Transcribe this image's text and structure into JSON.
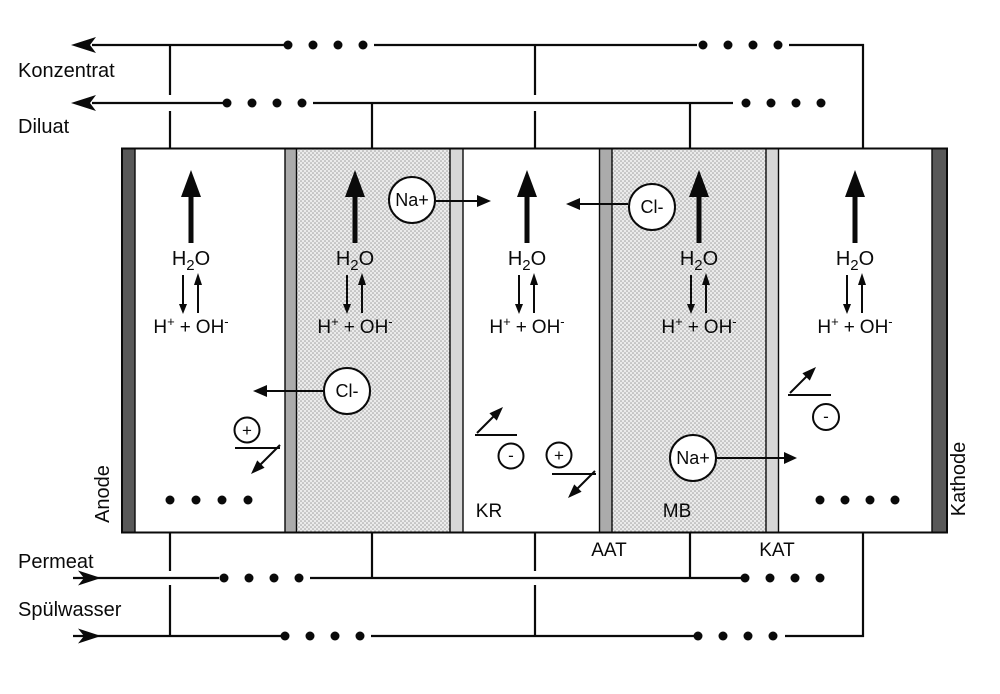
{
  "streams": {
    "konzentrat": {
      "label": "Konzentrat"
    },
    "diluat": {
      "label": "Diluat"
    },
    "permeat": {
      "label": "Permeat"
    },
    "spuelwasser": {
      "label": "Spülwasser"
    }
  },
  "electrodes": {
    "anode": "Anode",
    "kathode": "Kathode"
  },
  "membrane_labels": {
    "aat": "AAT",
    "kat": "KAT"
  },
  "chamber_labels": {
    "kr": "KR",
    "mb": "MB"
  },
  "ions": {
    "natrium": "Na+",
    "chlorid": "Cl-",
    "plus": "+",
    "minus": "-"
  },
  "reaction": {
    "water": {
      "h": "H",
      "sub": "2",
      "o": "O"
    },
    "dissociation": {
      "h": "H",
      "h_charge": "+",
      "plus": "+",
      "oh": "OH",
      "oh_charge": "-"
    }
  },
  "colors": {
    "line": "#0a0a0a",
    "electrode": "#595959",
    "membrane_aat": "#ababab",
    "membrane_kat": "#d7d7d7",
    "resin_bg": "#ebebeb",
    "resin_dot": "#9e9e9e",
    "chamber_bg": "#ffffff"
  }
}
